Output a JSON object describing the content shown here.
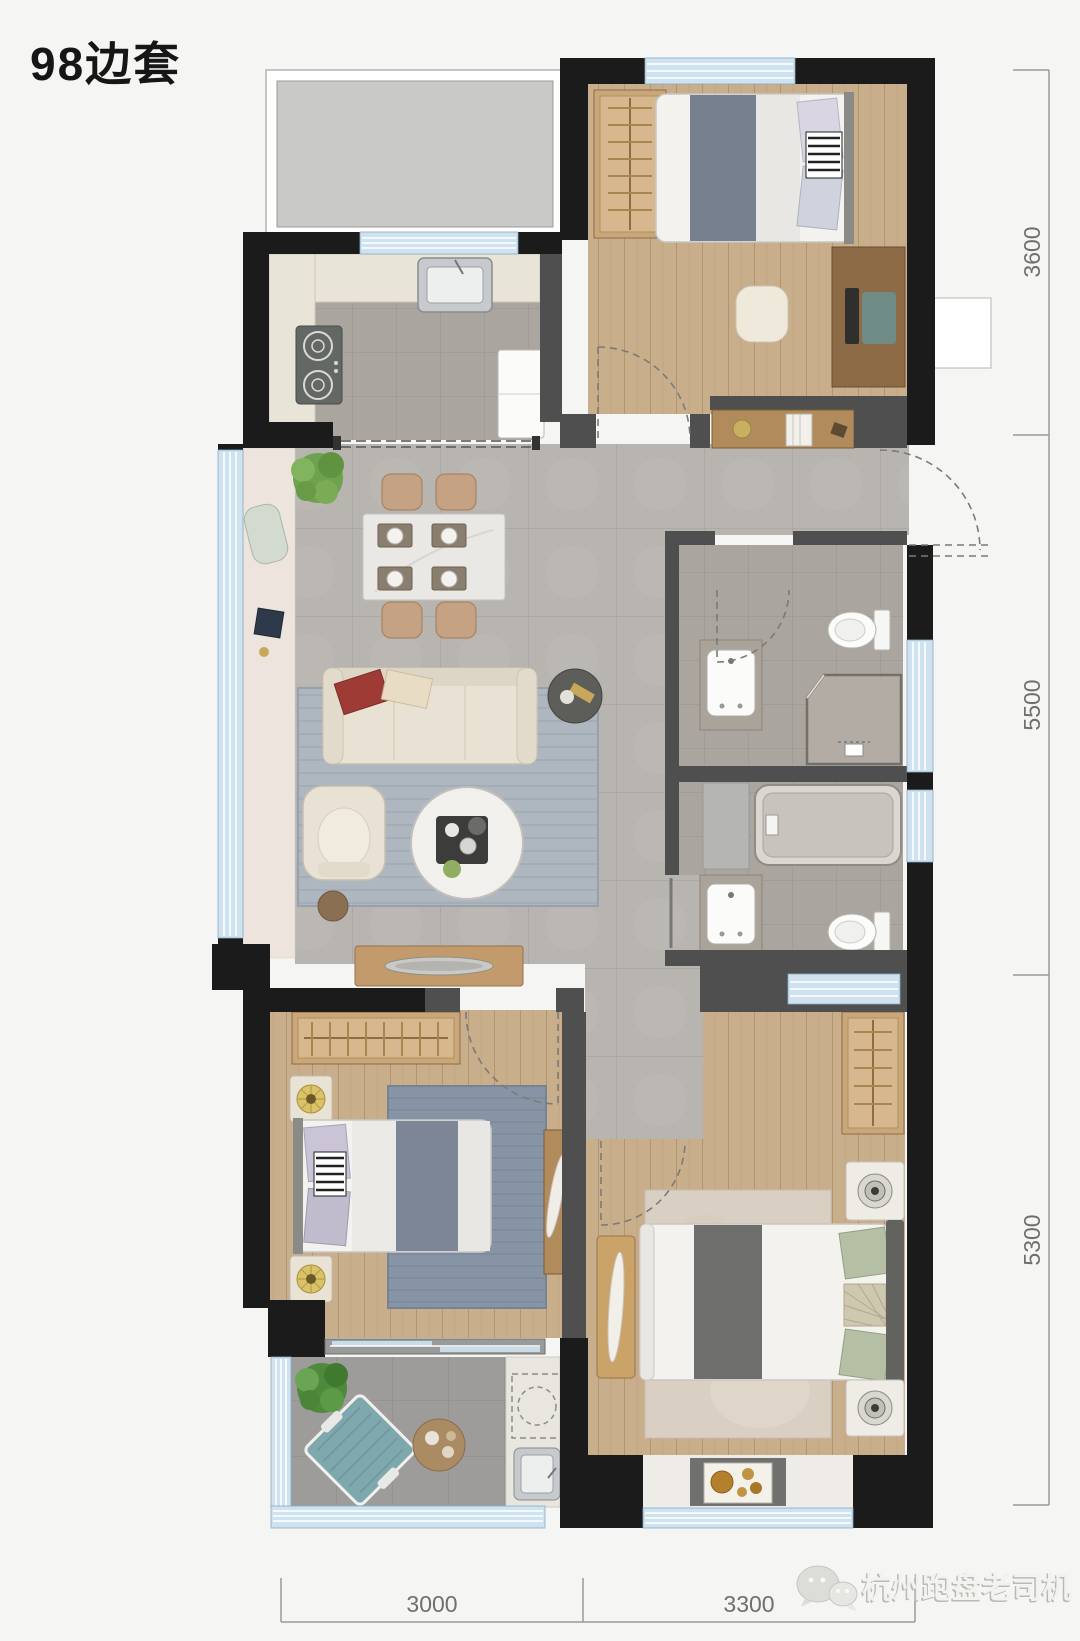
{
  "title": "98边套",
  "dimensions": {
    "right": [
      {
        "label": "3600"
      },
      {
        "label": "5500"
      },
      {
        "label": "5300"
      }
    ],
    "bottom": [
      {
        "label": "3000"
      },
      {
        "label": "3300"
      }
    ]
  },
  "watermark": {
    "icon": "wechat-icon",
    "text": "杭州跑盘老司机"
  },
  "palette": {
    "background": "#f5f5f3",
    "wall": "#1b1b1b",
    "partition": "#4f4f4f",
    "window_glass": "#cfe2f0",
    "wood_floor": "#c9ae8c",
    "living_tile": "#b8b5b1",
    "kitchen_bath_tile": "#aba59f",
    "balcony_tile": "#9d9c9a",
    "counter_cream": "#e9e4d8",
    "void_gray": "#c9c9c8",
    "dimension_line": "#9a9a98",
    "dimension_text": "#6f6f6d"
  }
}
